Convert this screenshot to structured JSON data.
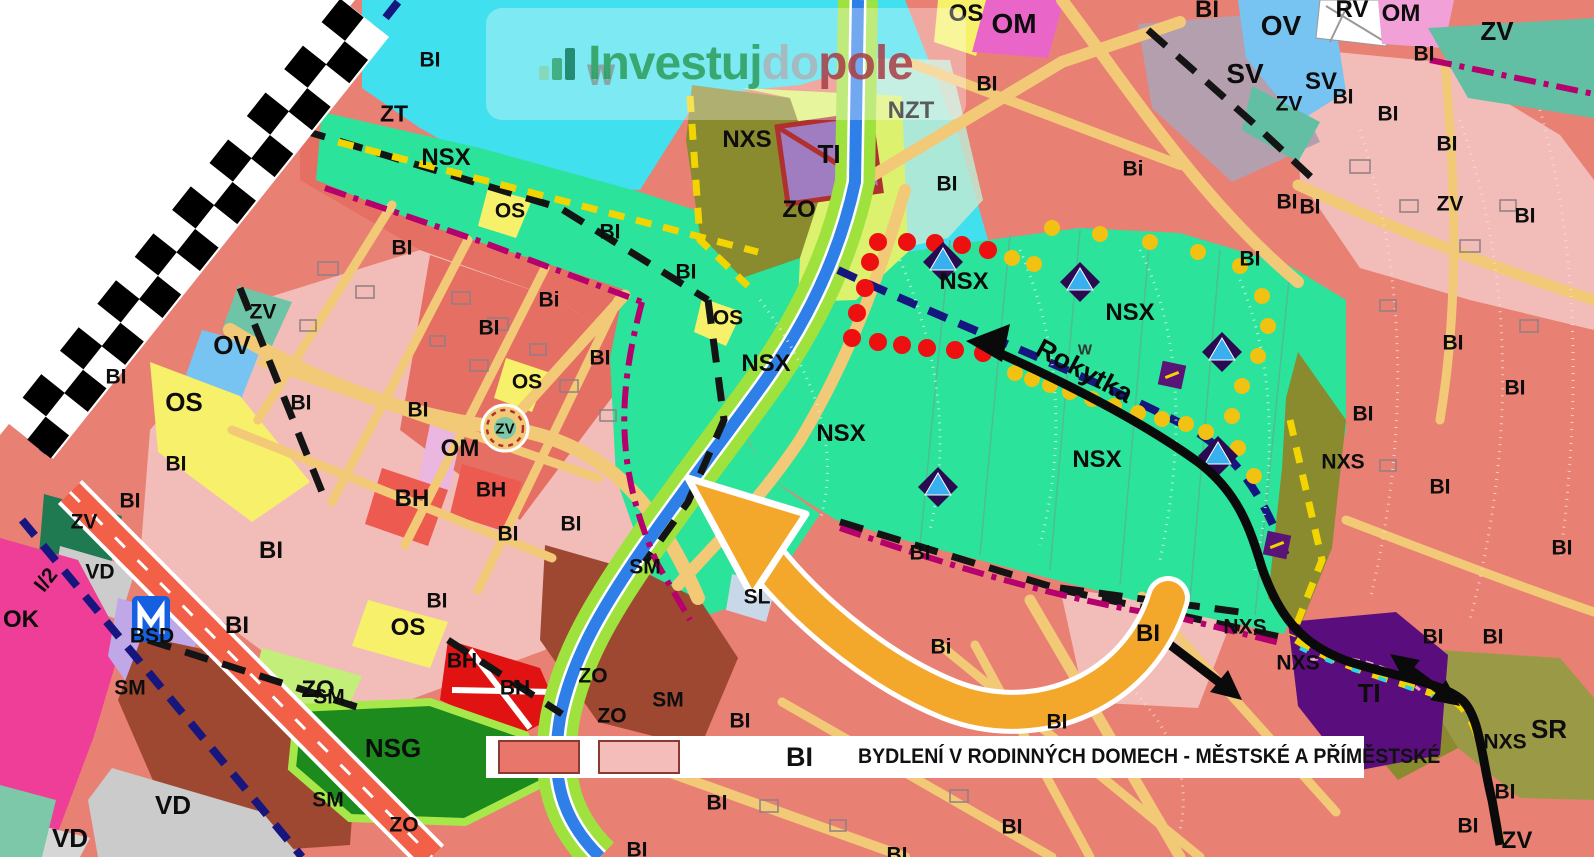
{
  "watermark": {
    "icon": "bar-chart-icon",
    "text_part1": "Investuj",
    "text_part2": "do",
    "text_part3": "pole",
    "color_part1": "#2F9E5F",
    "color_part2": "#ABB5BC",
    "color_part3": "#A9414B"
  },
  "legend": {
    "code": "BI",
    "description": "BYDLENÍ V RODINNÝCH DOMECH - MĚSTSKÉ A PŘÍMĚSTSKÉ",
    "swatch_colors": [
      "#E8766B",
      "#F4BDB9"
    ]
  },
  "annotations": {
    "stream_name": "Rokytka"
  },
  "map": {
    "symbols": [
      "red-dot-marker",
      "yellow-dot-marker",
      "viewpoint-triangle-marker",
      "purple-square-marker",
      "metro-station-icon",
      "roundabout",
      "municipal-boundary-checker",
      "highlight-arrow"
    ],
    "zone_colors": {
      "BI_built": "#E98074",
      "BI_planned": "#F2BDB8",
      "NSX": "#2BE39B",
      "W": "#40E0EE",
      "OS": "#F7F06A",
      "OV": "#77C4F2",
      "ZV": "#5BBFA0",
      "NSG": "#1C8A1C",
      "OK": "#EF3E98",
      "SM": "#9E4832",
      "BH": "#E01212",
      "TI": "#5A0E7E",
      "BSD": "#C0A8E8",
      "NXS": "#8A8A2E",
      "ZO": "#C8EE7A",
      "VD": "#CBCBCB",
      "SV": "#B49FAE",
      "OM": "#E966C8",
      "SL": "#C8D8E8"
    },
    "labels": [
      {
        "t": "BI",
        "x": 430,
        "y": 60
      },
      {
        "t": "ZT",
        "x": 394,
        "y": 114,
        "s": 23
      },
      {
        "t": "NSX",
        "x": 446,
        "y": 158,
        "s": 24
      },
      {
        "t": "OS",
        "x": 510,
        "y": 211
      },
      {
        "t": "BI",
        "x": 402,
        "y": 248
      },
      {
        "t": "BI",
        "x": 610,
        "y": 232
      },
      {
        "t": "Bi",
        "x": 549,
        "y": 300
      },
      {
        "t": "BI",
        "x": 686,
        "y": 272
      },
      {
        "t": "OS",
        "x": 728,
        "y": 318
      },
      {
        "t": "BI",
        "x": 489,
        "y": 328
      },
      {
        "t": "ZV",
        "x": 263,
        "y": 312
      },
      {
        "t": "OV",
        "x": 232,
        "y": 345,
        "s": 26
      },
      {
        "t": "BI",
        "x": 116,
        "y": 377
      },
      {
        "t": "OS",
        "x": 184,
        "y": 402,
        "s": 26
      },
      {
        "t": "BI",
        "x": 301,
        "y": 403
      },
      {
        "t": "OS",
        "x": 527,
        "y": 382
      },
      {
        "t": "BI",
        "x": 600,
        "y": 358
      },
      {
        "t": "ZV",
        "x": 505,
        "y": 429,
        "s": 15
      },
      {
        "t": "OM",
        "x": 460,
        "y": 449,
        "s": 24
      },
      {
        "t": "BI",
        "x": 418,
        "y": 410
      },
      {
        "t": "BI",
        "x": 176,
        "y": 464
      },
      {
        "t": "BH",
        "x": 412,
        "y": 499,
        "s": 24
      },
      {
        "t": "BH",
        "x": 491,
        "y": 490
      },
      {
        "t": "BI",
        "x": 130,
        "y": 501
      },
      {
        "t": "ZV",
        "x": 84,
        "y": 522
      },
      {
        "t": "BI",
        "x": 271,
        "y": 551,
        "s": 24
      },
      {
        "t": "BI",
        "x": 508,
        "y": 534
      },
      {
        "t": "BI",
        "x": 571,
        "y": 524
      },
      {
        "t": "VD",
        "x": 100,
        "y": 572
      },
      {
        "t": "I/2",
        "x": 46,
        "y": 580,
        "r": -52
      },
      {
        "t": "OK",
        "x": 21,
        "y": 620,
        "s": 24
      },
      {
        "t": "BSD",
        "x": 152,
        "y": 636
      },
      {
        "t": "BI",
        "x": 237,
        "y": 626,
        "s": 24
      },
      {
        "t": "BI",
        "x": 437,
        "y": 601
      },
      {
        "t": "OS",
        "x": 408,
        "y": 628,
        "s": 24
      },
      {
        "t": "SM",
        "x": 130,
        "y": 688
      },
      {
        "t": "SM",
        "x": 329,
        "y": 697
      },
      {
        "t": "BH",
        "x": 462,
        "y": 661
      },
      {
        "t": "BH",
        "x": 515,
        "y": 688
      },
      {
        "t": "ZO",
        "x": 318,
        "y": 690,
        "s": 24
      },
      {
        "t": "NSG",
        "x": 393,
        "y": 748,
        "s": 26
      },
      {
        "t": "SM",
        "x": 328,
        "y": 800
      },
      {
        "t": "VD",
        "x": 173,
        "y": 805,
        "s": 26
      },
      {
        "t": "VD",
        "x": 70,
        "y": 838,
        "s": 26
      },
      {
        "t": "ZO",
        "x": 404,
        "y": 825
      },
      {
        "t": "ZO",
        "x": 593,
        "y": 676
      },
      {
        "t": "ZO",
        "x": 612,
        "y": 716
      },
      {
        "t": "SM",
        "x": 645,
        "y": 567
      },
      {
        "t": "SM",
        "x": 668,
        "y": 700
      },
      {
        "t": "SL",
        "x": 757,
        "y": 597
      },
      {
        "t": "BI",
        "x": 920,
        "y": 553
      },
      {
        "t": "Bi",
        "x": 941,
        "y": 647
      },
      {
        "t": "BI",
        "x": 740,
        "y": 721
      },
      {
        "t": "BI",
        "x": 717,
        "y": 803
      },
      {
        "t": "BI",
        "x": 637,
        "y": 850
      },
      {
        "t": "BI",
        "x": 897,
        "y": 855
      },
      {
        "t": "BI",
        "x": 1012,
        "y": 827
      },
      {
        "t": "NSX",
        "x": 766,
        "y": 364,
        "s": 24
      },
      {
        "t": "NSX",
        "x": 841,
        "y": 434,
        "s": 24
      },
      {
        "t": "NSX",
        "x": 964,
        "y": 282,
        "s": 24
      },
      {
        "t": "NSX",
        "x": 1130,
        "y": 313,
        "s": 24
      },
      {
        "t": "NSX",
        "x": 1097,
        "y": 460,
        "s": 24
      },
      {
        "t": "W",
        "x": 1085,
        "y": 350,
        "s": 15,
        "c": "#333333"
      },
      {
        "t": "NXS",
        "x": 747,
        "y": 140,
        "s": 24
      },
      {
        "t": "TI",
        "x": 829,
        "y": 154,
        "s": 26
      },
      {
        "t": "ZO",
        "x": 799,
        "y": 210,
        "s": 24
      },
      {
        "t": "NZT",
        "x": 911,
        "y": 111,
        "s": 24
      },
      {
        "t": "BI",
        "x": 947,
        "y": 184
      },
      {
        "t": "Bi",
        "x": 1133,
        "y": 169
      },
      {
        "t": "BI",
        "x": 1250,
        "y": 259
      },
      {
        "t": "BI",
        "x": 1287,
        "y": 202
      },
      {
        "t": "W",
        "x": 601,
        "y": 76,
        "s": 30,
        "c": "#4E7F7F"
      },
      {
        "t": "OS",
        "x": 966,
        "y": 14,
        "s": 24
      },
      {
        "t": "OM",
        "x": 1014,
        "y": 24,
        "s": 28
      },
      {
        "t": "BI",
        "x": 987,
        "y": 84
      },
      {
        "t": "SV",
        "x": 1245,
        "y": 74,
        "s": 28
      },
      {
        "t": "OV",
        "x": 1281,
        "y": 26,
        "s": 28
      },
      {
        "t": "BI",
        "x": 1207,
        "y": 10,
        "s": 24
      },
      {
        "t": "ZV",
        "x": 1289,
        "y": 104
      },
      {
        "t": "RV",
        "x": 1352,
        "y": 10,
        "s": 24
      },
      {
        "t": "OM",
        "x": 1401,
        "y": 14,
        "s": 24
      },
      {
        "t": "ZV",
        "x": 1497,
        "y": 31,
        "s": 26
      },
      {
        "t": "BI",
        "x": 1424,
        "y": 54
      },
      {
        "t": "SV",
        "x": 1321,
        "y": 82,
        "s": 24
      },
      {
        "t": "BI",
        "x": 1343,
        "y": 97
      },
      {
        "t": "BI",
        "x": 1388,
        "y": 114
      },
      {
        "t": "BI",
        "x": 1447,
        "y": 144
      },
      {
        "t": "ZV",
        "x": 1450,
        "y": 204
      },
      {
        "t": "BI",
        "x": 1310,
        "y": 207
      },
      {
        "t": "BI",
        "x": 1525,
        "y": 216
      },
      {
        "t": "BI",
        "x": 1453,
        "y": 343
      },
      {
        "t": "BI",
        "x": 1515,
        "y": 388
      },
      {
        "t": "BI",
        "x": 1363,
        "y": 414
      },
      {
        "t": "NXS",
        "x": 1343,
        "y": 462
      },
      {
        "t": "BI",
        "x": 1440,
        "y": 487
      },
      {
        "t": "BI",
        "x": 1562,
        "y": 548
      },
      {
        "t": "BI",
        "x": 1148,
        "y": 634,
        "s": 24
      },
      {
        "t": "NXS",
        "x": 1245,
        "y": 627
      },
      {
        "t": "NXS",
        "x": 1298,
        "y": 663
      },
      {
        "t": "BI",
        "x": 1433,
        "y": 637
      },
      {
        "t": "BI",
        "x": 1493,
        "y": 637
      },
      {
        "t": "TI",
        "x": 1369,
        "y": 693,
        "s": 26
      },
      {
        "t": "SR",
        "x": 1549,
        "y": 729,
        "s": 26
      },
      {
        "t": "NXS",
        "x": 1505,
        "y": 742
      },
      {
        "t": "BI",
        "x": 1057,
        "y": 722
      },
      {
        "t": "BI",
        "x": 1505,
        "y": 792
      },
      {
        "t": "BI",
        "x": 1468,
        "y": 826
      },
      {
        "t": "ZV",
        "x": 1517,
        "y": 841,
        "s": 24
      }
    ]
  }
}
